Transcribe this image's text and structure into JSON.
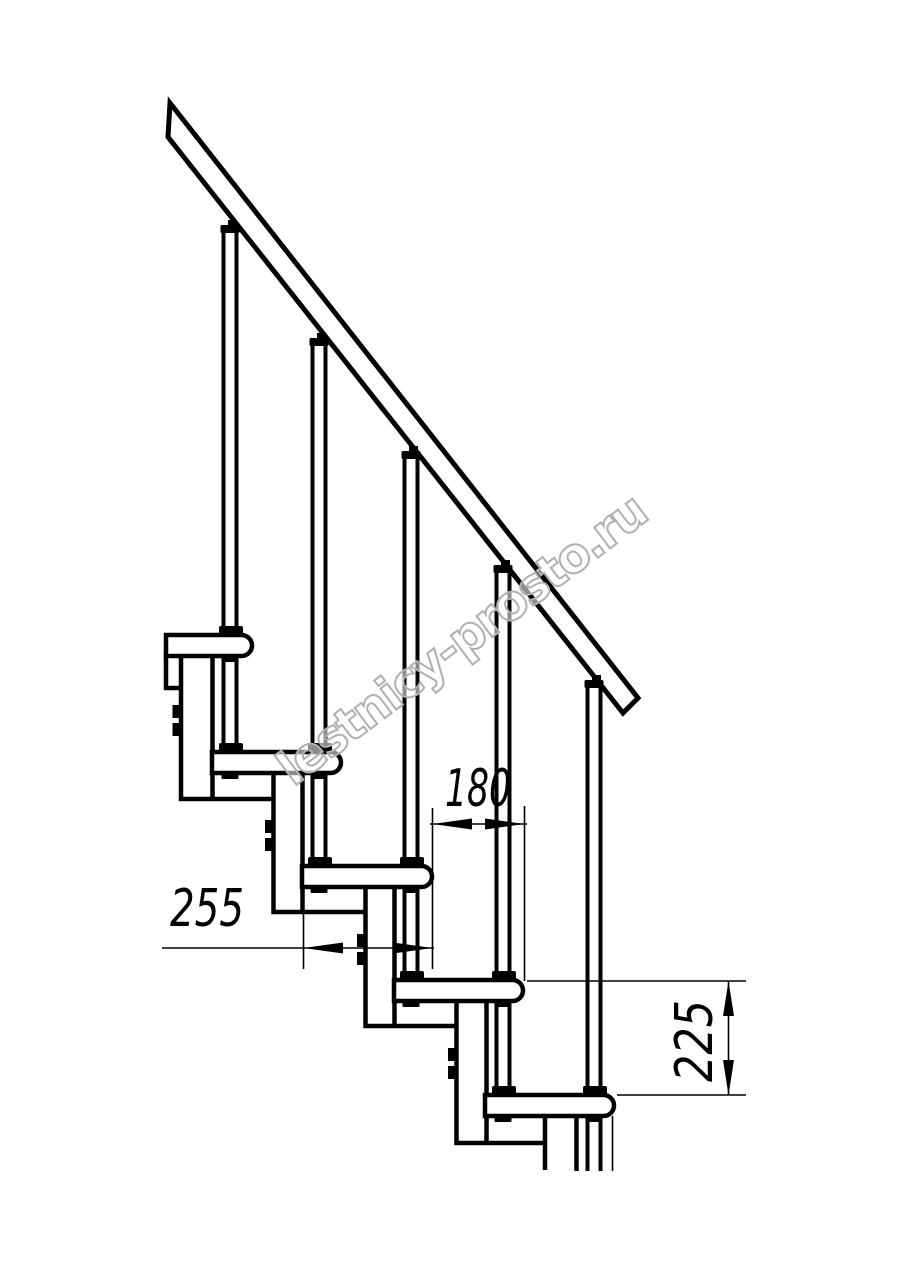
{
  "watermark": "lestnicy-prosto.ru",
  "dimensions": {
    "step_run": "180",
    "tread_depth": "255",
    "step_rise": "225"
  },
  "colors": {
    "line": "#000000",
    "watermark_outline": "#b0b0b0",
    "background": "#ffffff"
  },
  "figure": {
    "treads_visible": "5",
    "balusters_visible": "5"
  }
}
